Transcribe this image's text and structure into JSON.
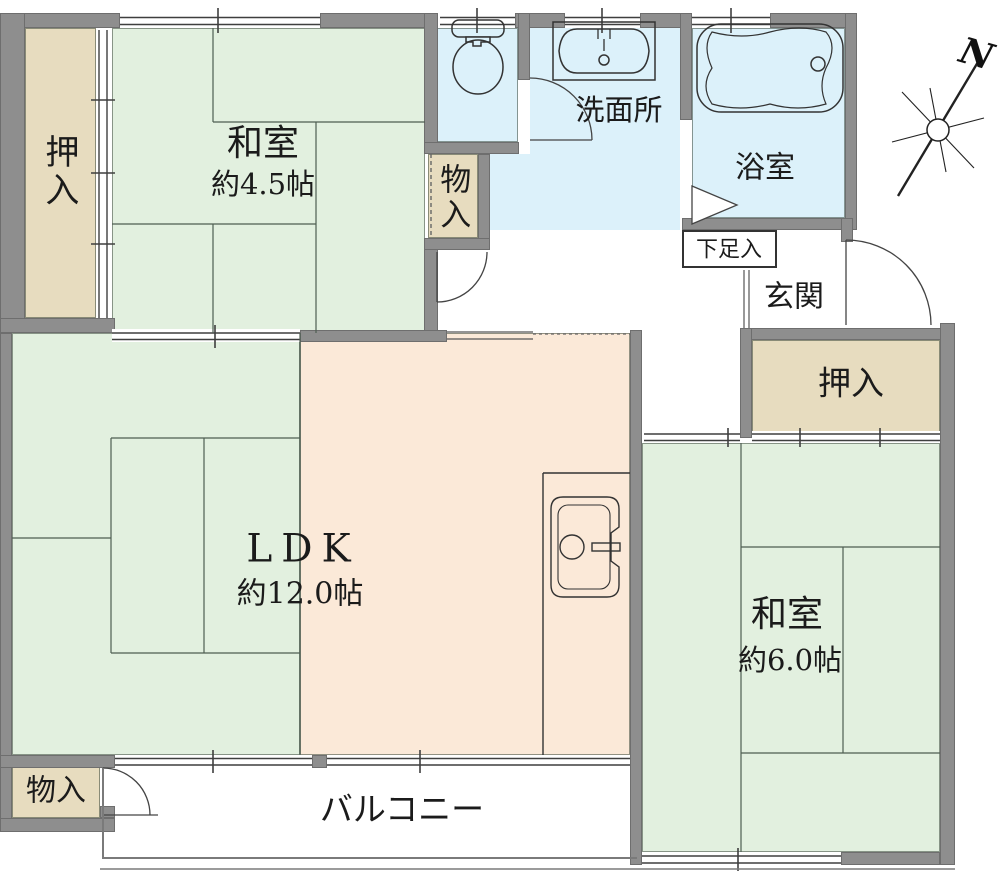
{
  "floorplan": {
    "rooms": {
      "closet_top_left": {
        "label": "押入"
      },
      "japanese_room_45": {
        "label": "和室",
        "size": "約4.5帖"
      },
      "storage_top": {
        "label": "物入"
      },
      "washroom": {
        "label": "洗面所"
      },
      "bathroom": {
        "label": "浴室"
      },
      "shoe_cabinet": {
        "label": "下足入"
      },
      "entrance": {
        "label": "玄関"
      },
      "closet_right": {
        "label": "押入"
      },
      "ldk": {
        "label": "LDK",
        "size": "約12.0帖"
      },
      "japanese_room_60": {
        "label": "和室",
        "size": "約6.0帖"
      },
      "storage_bottom": {
        "label": "物入"
      },
      "balcony": {
        "label": "バルコニー"
      }
    },
    "compass": {
      "label": "N"
    },
    "fixtures": [
      "toilet",
      "wash-basin",
      "bathtub",
      "kitchen-sink"
    ],
    "colors": {
      "tatami_green": "#e2f0df",
      "closet_tan": "#e7dcbf",
      "wet_area_blue": "#dcf1fa",
      "ldk_peach": "#fbe9d8",
      "wall_gray": "#8e8e8e"
    }
  }
}
